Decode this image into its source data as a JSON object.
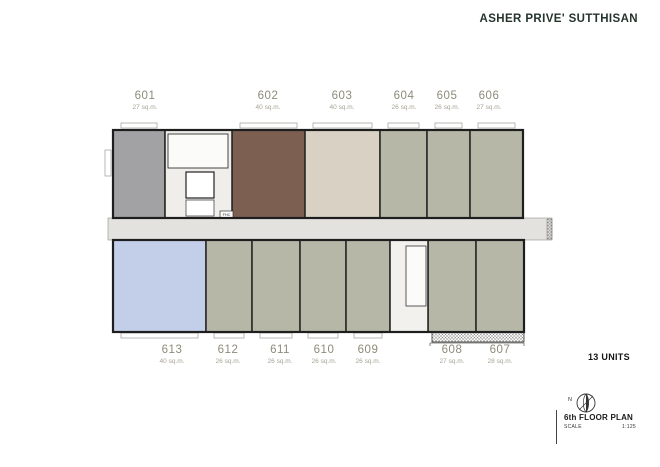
{
  "header": {
    "title": "ASHER PRIVE' SUTTHISAN"
  },
  "summary": {
    "units_count": "13 UNITS"
  },
  "titleblock": {
    "plan_name": "6th FLOOR PLAN",
    "scale_label": "SCALE",
    "scale_value": "1:125",
    "north_label": "N"
  },
  "plan": {
    "fhc_label": "FHC",
    "colors": {
      "gray": "#a2a1a3",
      "brown": "#7c5f51",
      "beige": "#d8d1c4",
      "sage": "#b6b7a7",
      "blue": "#c3cee8",
      "corridor": "#e3e2df",
      "core": "#efeeeb",
      "void": "#f2f1ee",
      "wall": "#2b2b2b"
    },
    "units": [
      {
        "no": "601",
        "area": "27 sq.m.",
        "color": "gray",
        "type": "a-top",
        "row": "top",
        "x": 13,
        "y": 10,
        "w": 52,
        "h": 88,
        "lx": 45
      },
      {
        "no": "602",
        "area": "40 sq.m.",
        "color": "brown",
        "type": "b-top",
        "row": "top",
        "x": 132,
        "y": 10,
        "w": 73,
        "h": 88,
        "lx": 168
      },
      {
        "no": "603",
        "area": "40 sq.m.",
        "color": "beige",
        "type": "b-top",
        "row": "top",
        "x": 205,
        "y": 10,
        "w": 75,
        "h": 88,
        "lx": 242
      },
      {
        "no": "604",
        "area": "26 sq.m.",
        "color": "sage",
        "type": "s-top",
        "row": "top",
        "x": 280,
        "y": 10,
        "w": 47,
        "h": 88,
        "lx": 304
      },
      {
        "no": "605",
        "area": "26 sq.m.",
        "color": "sage",
        "type": "s-top",
        "row": "top",
        "x": 327,
        "y": 10,
        "w": 43,
        "h": 88,
        "lx": 347
      },
      {
        "no": "606",
        "area": "27 sq.m.",
        "color": "sage",
        "type": "s-top",
        "row": "top",
        "x": 370,
        "y": 10,
        "w": 53,
        "h": 88,
        "lx": 389
      },
      {
        "no": "613",
        "area": "40 sq.m.",
        "color": "blue",
        "type": "b-bottom",
        "row": "bottom",
        "x": 13,
        "y": 120,
        "w": 93,
        "h": 92,
        "lx": 72
      },
      {
        "no": "612",
        "area": "26 sq.m.",
        "color": "sage",
        "type": "s-bottom",
        "row": "bottom",
        "x": 106,
        "y": 120,
        "w": 46,
        "h": 92,
        "lx": 128
      },
      {
        "no": "611",
        "area": "26 sq.m.",
        "color": "sage",
        "type": "s-bottom",
        "row": "bottom",
        "x": 152,
        "y": 120,
        "w": 48,
        "h": 92,
        "lx": 180
      },
      {
        "no": "610",
        "area": "26 sq.m.",
        "color": "sage",
        "type": "s-bottom",
        "row": "bottom",
        "x": 200,
        "y": 120,
        "w": 46,
        "h": 92,
        "lx": 224
      },
      {
        "no": "609",
        "area": "26 sq.m.",
        "color": "sage",
        "type": "s-bottom",
        "row": "bottom",
        "x": 246,
        "y": 120,
        "w": 44,
        "h": 92,
        "lx": 268
      },
      {
        "no": "608",
        "area": "27 sq.m.",
        "color": "sage",
        "type": "s-bottom",
        "row": "bottom",
        "x": 328,
        "y": 120,
        "w": 48,
        "h": 92,
        "lx": 352
      },
      {
        "no": "607",
        "area": "28 sq.m.",
        "color": "sage",
        "type": "s-bottom",
        "row": "bottom",
        "x": 376,
        "y": 120,
        "w": 48,
        "h": 92,
        "lx": 400
      }
    ]
  }
}
